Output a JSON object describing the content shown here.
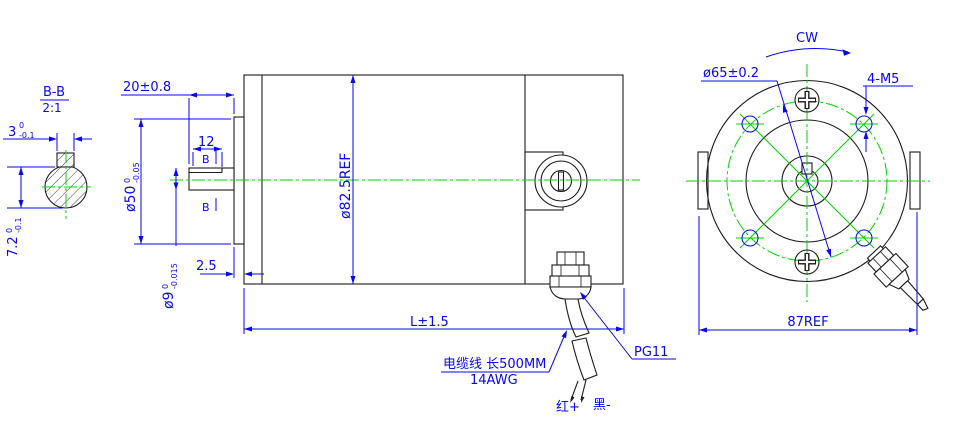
{
  "colors": {
    "dimension": "#0707f0",
    "geometry": "#1c1c1c",
    "centerline": "#00d300",
    "background": "#ffffff"
  },
  "detail_view": {
    "title": "B-B",
    "scale": "2:1",
    "width_dim": {
      "nominal": "3",
      "upper": "0",
      "lower": "-0.1"
    },
    "height_dim": {
      "nominal": "7.2",
      "upper": "0",
      "lower": "-0.1"
    }
  },
  "side_view": {
    "shaft_extension_dim": "20±0.8",
    "key_length_dim": "12",
    "section_letter": "B",
    "pilot_diameter_dim": {
      "nominal": "ø50",
      "upper": "0",
      "lower": "-0.05"
    },
    "shaft_diameter_dim": {
      "nominal": "ø9",
      "upper": "0",
      "lower": "-0.015"
    },
    "pilot_depth_dim": "2.5",
    "body_diameter_dim": "ø82.5REF",
    "overall_length_dim": "L±1.5",
    "gland_label": "PG11",
    "cable_note_line1": "电缆线 长500MM",
    "cable_note_line2": "14AWG",
    "wire_positive_label": "红+",
    "wire_negative_label": "黑-"
  },
  "front_view": {
    "rotation_label": "CW",
    "bolt_circle_dim": "ø65±0.2",
    "mount_holes_label": "4-M5",
    "width_dim": "87REF"
  }
}
